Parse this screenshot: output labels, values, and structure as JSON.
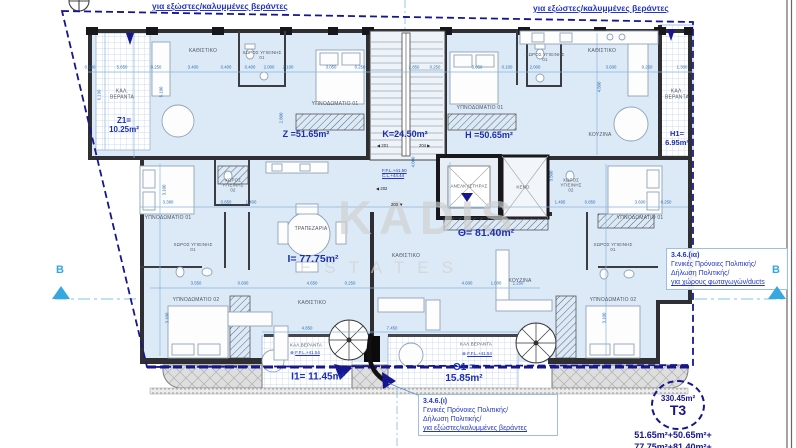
{
  "header": {
    "top_left_note": "για εξώστες/καλυμμένες βεράντες",
    "top_right_note": "για εξώστες/καλυμμένες βεράντες"
  },
  "watermark": {
    "line1": "KADIS",
    "line2": "ESTATES"
  },
  "section_marker": {
    "left": "B",
    "right": "B"
  },
  "apartment_areas": {
    "z1_name": "Z1=",
    "z1_value": "10.25m²",
    "z": "Z =51.65m²",
    "k": "K=24.50m²",
    "h": "H =50.65m²",
    "h1_name": "H1=",
    "h1_value": "6.95m²",
    "i": "I= 77.75m²",
    "theta": "Θ= 81.40m²",
    "i1": "I1= 11.45m²",
    "theta1_name": "Θ1 =",
    "theta1_value": "15.85m²"
  },
  "summary": {
    "total_area": "330.45m²",
    "unit_type": "T3",
    "sum_line1": "51.65m²+50.65m²+",
    "sum_line2": "77.75m²+81.40m²+"
  },
  "notes": {
    "duct_ref": "3.4.6.(ια)",
    "duct_line1": "Γενικές Πρόνοιες Πολιτικής/",
    "duct_line2": "Δήλωση Πολιτικής/",
    "duct_line3": "για χώρους φωταγωγών/ducts",
    "veranda_ref": "3.4.6.(ι)",
    "veranda_line1": "Γενικές Πρόνοιες Πολιτικής/",
    "veranda_line2": "Δήλωση Πολιτικής/",
    "veranda_line3": "για εξώστες/καλυμμένες βεράντες"
  },
  "levels": {
    "lift_ffl": "F.F.L.+41.50",
    "lift_cl": "C.L.+44.44",
    "veranda_ffl_left": "F.F.L.+41.54",
    "veranda_ffl_right": "F.F.L.+41.54",
    "marker_glyph": "⊕"
  },
  "door_tags": {
    "t201": "◀ 201",
    "t202": "◀ 202",
    "t203": "203 ▼",
    "t204": "204 ▶"
  },
  "room_labels": [
    {
      "t": "ΚΑΘΙΣΤΙΚΟ",
      "x": 203,
      "y": 52
    },
    {
      "t": "ΧΩΡΟΣ ΥΓΙΕΙΝΗΣ\n01",
      "x": 262,
      "y": 55,
      "fs": 4.4
    },
    {
      "t": "ΥΠΝΟΔΩΜΑΤΙΟ 01",
      "x": 335,
      "y": 105
    },
    {
      "t": "ΚΑΛ.\nΒΕΡΑΝΤΑ",
      "x": 122,
      "y": 95
    },
    {
      "t": "ΚΑΘΙΣΤΙΚΟ",
      "x": 602,
      "y": 52
    },
    {
      "t": "ΧΩΡΟΣ ΥΓΙΕΙΝΗΣ\n01",
      "x": 545,
      "y": 57,
      "fs": 4.4
    },
    {
      "t": "ΥΠΝΟΔΩΜΑΤΙΟ 01",
      "x": 480,
      "y": 109
    },
    {
      "t": "ΚΟΥΖΙΝΑ",
      "x": 600,
      "y": 136
    },
    {
      "t": "ΚΑΛ.\nΒΕΡΑΝΤΑ",
      "x": 677,
      "y": 95
    },
    {
      "t": "ΑΝΕΛΚΥΣΤΗΡΑΣ",
      "x": 469,
      "y": 186,
      "fs": 4.4
    },
    {
      "t": "ΚΕΝΟ",
      "x": 523,
      "y": 187,
      "fs": 4.4
    },
    {
      "t": "ΥΠΝΟΔΩΜΑΤΙΟ 01",
      "x": 168,
      "y": 219
    },
    {
      "t": "ΧΩΡΟΣ\nΥΓΙΕΙΝΗΣ\n02",
      "x": 233,
      "y": 185,
      "fs": 4.4
    },
    {
      "t": "ΧΩΡΟΣ ΥΓΙΕΙΝΗΣ\n01",
      "x": 193,
      "y": 247,
      "fs": 4.4
    },
    {
      "t": "ΤΡΑΠΕΖΑΡΙΑ",
      "x": 311,
      "y": 230
    },
    {
      "t": "ΥΠΝΟΔΩΜΑΤΙΟ 02",
      "x": 196,
      "y": 301
    },
    {
      "t": "ΚΑΘΙΣΤΙΚΟ",
      "x": 312,
      "y": 304
    },
    {
      "t": "ΚΑΘΙΣΤΙΚΟ",
      "x": 406,
      "y": 257
    },
    {
      "t": "ΚΟΥΖΙΝΑ",
      "x": 520,
      "y": 282
    },
    {
      "t": "ΥΠΝΟΔΩΜΑΤΙΟ 01",
      "x": 640,
      "y": 219
    },
    {
      "t": "ΧΩΡΟΣ\nΥΓΙΕΙΝΗΣ\n02",
      "x": 571,
      "y": 185,
      "fs": 4.4
    },
    {
      "t": "ΧΩΡΟΣ ΥΓΙΕΙΝΗΣ\n01",
      "x": 613,
      "y": 247,
      "fs": 4.4
    },
    {
      "t": "ΥΠΝΟΔΩΜΑΤΙΟ 02",
      "x": 613,
      "y": 301
    },
    {
      "t": "ΚΑΛ.ΒΕΡΑΝΤΑ",
      "x": 306,
      "y": 345,
      "fs": 4.4
    },
    {
      "t": "ΚΑΛ.ΒΕΡΑΝΤΑ",
      "x": 476,
      "y": 344,
      "fs": 4.4
    }
  ],
  "dims_h": [
    {
      "t": "0.100",
      "x": 90,
      "y": 67
    },
    {
      "t": "5.650",
      "x": 122,
      "y": 67
    },
    {
      "t": "0.250",
      "x": 156,
      "y": 67
    },
    {
      "t": "3.400",
      "x": 193,
      "y": 67
    },
    {
      "t": "0.400",
      "x": 226,
      "y": 67
    },
    {
      "t": "0.400",
      "x": 250,
      "y": 67
    },
    {
      "t": "2.000",
      "x": 269,
      "y": 67
    },
    {
      "t": "2.100",
      "x": 288,
      "y": 67
    },
    {
      "t": "3.050",
      "x": 331,
      "y": 67
    },
    {
      "t": "0.250",
      "x": 360,
      "y": 67
    },
    {
      "t": "2.850",
      "x": 414,
      "y": 67
    },
    {
      "t": "0.250",
      "x": 435,
      "y": 67
    },
    {
      "t": "3.050",
      "x": 477,
      "y": 67
    },
    {
      "t": "0.100",
      "x": 507,
      "y": 67
    },
    {
      "t": "2.000",
      "x": 535,
      "y": 67
    },
    {
      "t": "3.600",
      "x": 611,
      "y": 67
    },
    {
      "t": "0.250",
      "x": 647,
      "y": 67
    },
    {
      "t": "1.300",
      "x": 682,
      "y": 67
    },
    {
      "t": "3.380",
      "x": 168,
      "y": 202
    },
    {
      "t": "0.850",
      "x": 226,
      "y": 202
    },
    {
      "t": "1.400",
      "x": 251,
      "y": 202
    },
    {
      "t": "1.495",
      "x": 560,
      "y": 202
    },
    {
      "t": "0.850",
      "x": 590,
      "y": 202
    },
    {
      "t": "3.600",
      "x": 640,
      "y": 202
    },
    {
      "t": "0.250",
      "x": 666,
      "y": 202
    },
    {
      "t": "3.550",
      "x": 196,
      "y": 283
    },
    {
      "t": "0.600",
      "x": 243,
      "y": 283
    },
    {
      "t": "4.650",
      "x": 312,
      "y": 283
    },
    {
      "t": "0.250",
      "x": 350,
      "y": 283
    },
    {
      "t": "4.600",
      "x": 467,
      "y": 283
    },
    {
      "t": "1.000",
      "x": 496,
      "y": 283
    },
    {
      "t": "1.250",
      "x": 518,
      "y": 283
    },
    {
      "t": "4.850",
      "x": 307,
      "y": 328
    },
    {
      "t": "7.450",
      "x": 392,
      "y": 328
    }
  ],
  "dims_v": [
    {
      "t": "6.190",
      "x": 99,
      "y": 95
    },
    {
      "t": "5.180",
      "x": 161,
      "y": 92
    },
    {
      "t": "2.800",
      "x": 281,
      "y": 118
    },
    {
      "t": "4.000",
      "x": 413,
      "y": 162
    },
    {
      "t": "4.500",
      "x": 599,
      "y": 87
    },
    {
      "t": "3.500",
      "x": 551,
      "y": 176
    },
    {
      "t": "3.100",
      "x": 164,
      "y": 190
    },
    {
      "t": "3.100",
      "x": 167,
      "y": 318
    },
    {
      "t": "3.100",
      "x": 604,
      "y": 318
    }
  ],
  "colors": {
    "boundary_navy": "#16168f",
    "dimension_blue": "#2e6fb5",
    "area_label_blue": "#1c2fb0",
    "note_blue": "#2336c8",
    "section_cyan": "#35a8e0",
    "room_fill": "#dce9f6",
    "wall": "#2e2e33",
    "watermark_gray": "#cfcfcf"
  }
}
